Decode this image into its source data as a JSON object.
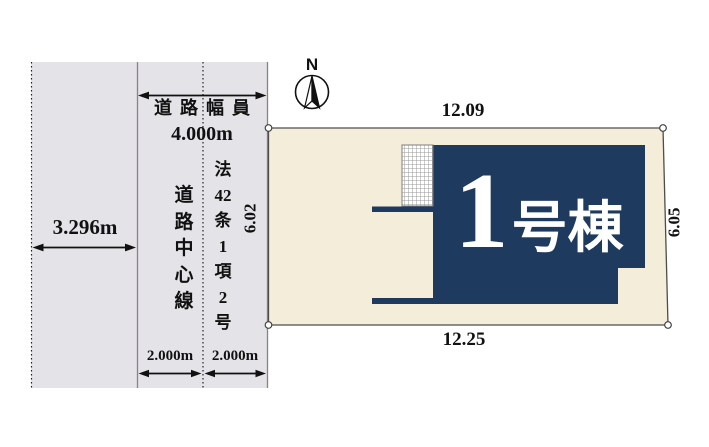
{
  "diagram_title": "lot-layout-plan",
  "colors": {
    "background": "#ffffff",
    "road_fill": "#e4e3e7",
    "plot_fill": "#f4edda",
    "building_fill": "#1e3a5f",
    "outline": "#4d4d4d",
    "text": "#111111",
    "building_text": "#ffffff"
  },
  "compass": {
    "north_label": "N"
  },
  "road": {
    "width_label": "道路幅員",
    "width_value": "4.000m",
    "opposite_side_width": "3.296m",
    "half_width_left": "2.000m",
    "half_width_right": "2.000m",
    "center_line_label": "道路中心線",
    "center_line_segments": [
      "道",
      "路",
      "中",
      "心",
      "線"
    ],
    "law_label": "法42条1項2号",
    "law_segments": [
      "法",
      "42",
      "条",
      "1",
      "項",
      "2",
      "号"
    ]
  },
  "plot": {
    "dim_top": "12.09",
    "dim_bottom": "12.25",
    "dim_left": "6.02",
    "dim_right": "6.05"
  },
  "building": {
    "number": "1",
    "suffix": "号棟",
    "label": "1号棟"
  }
}
